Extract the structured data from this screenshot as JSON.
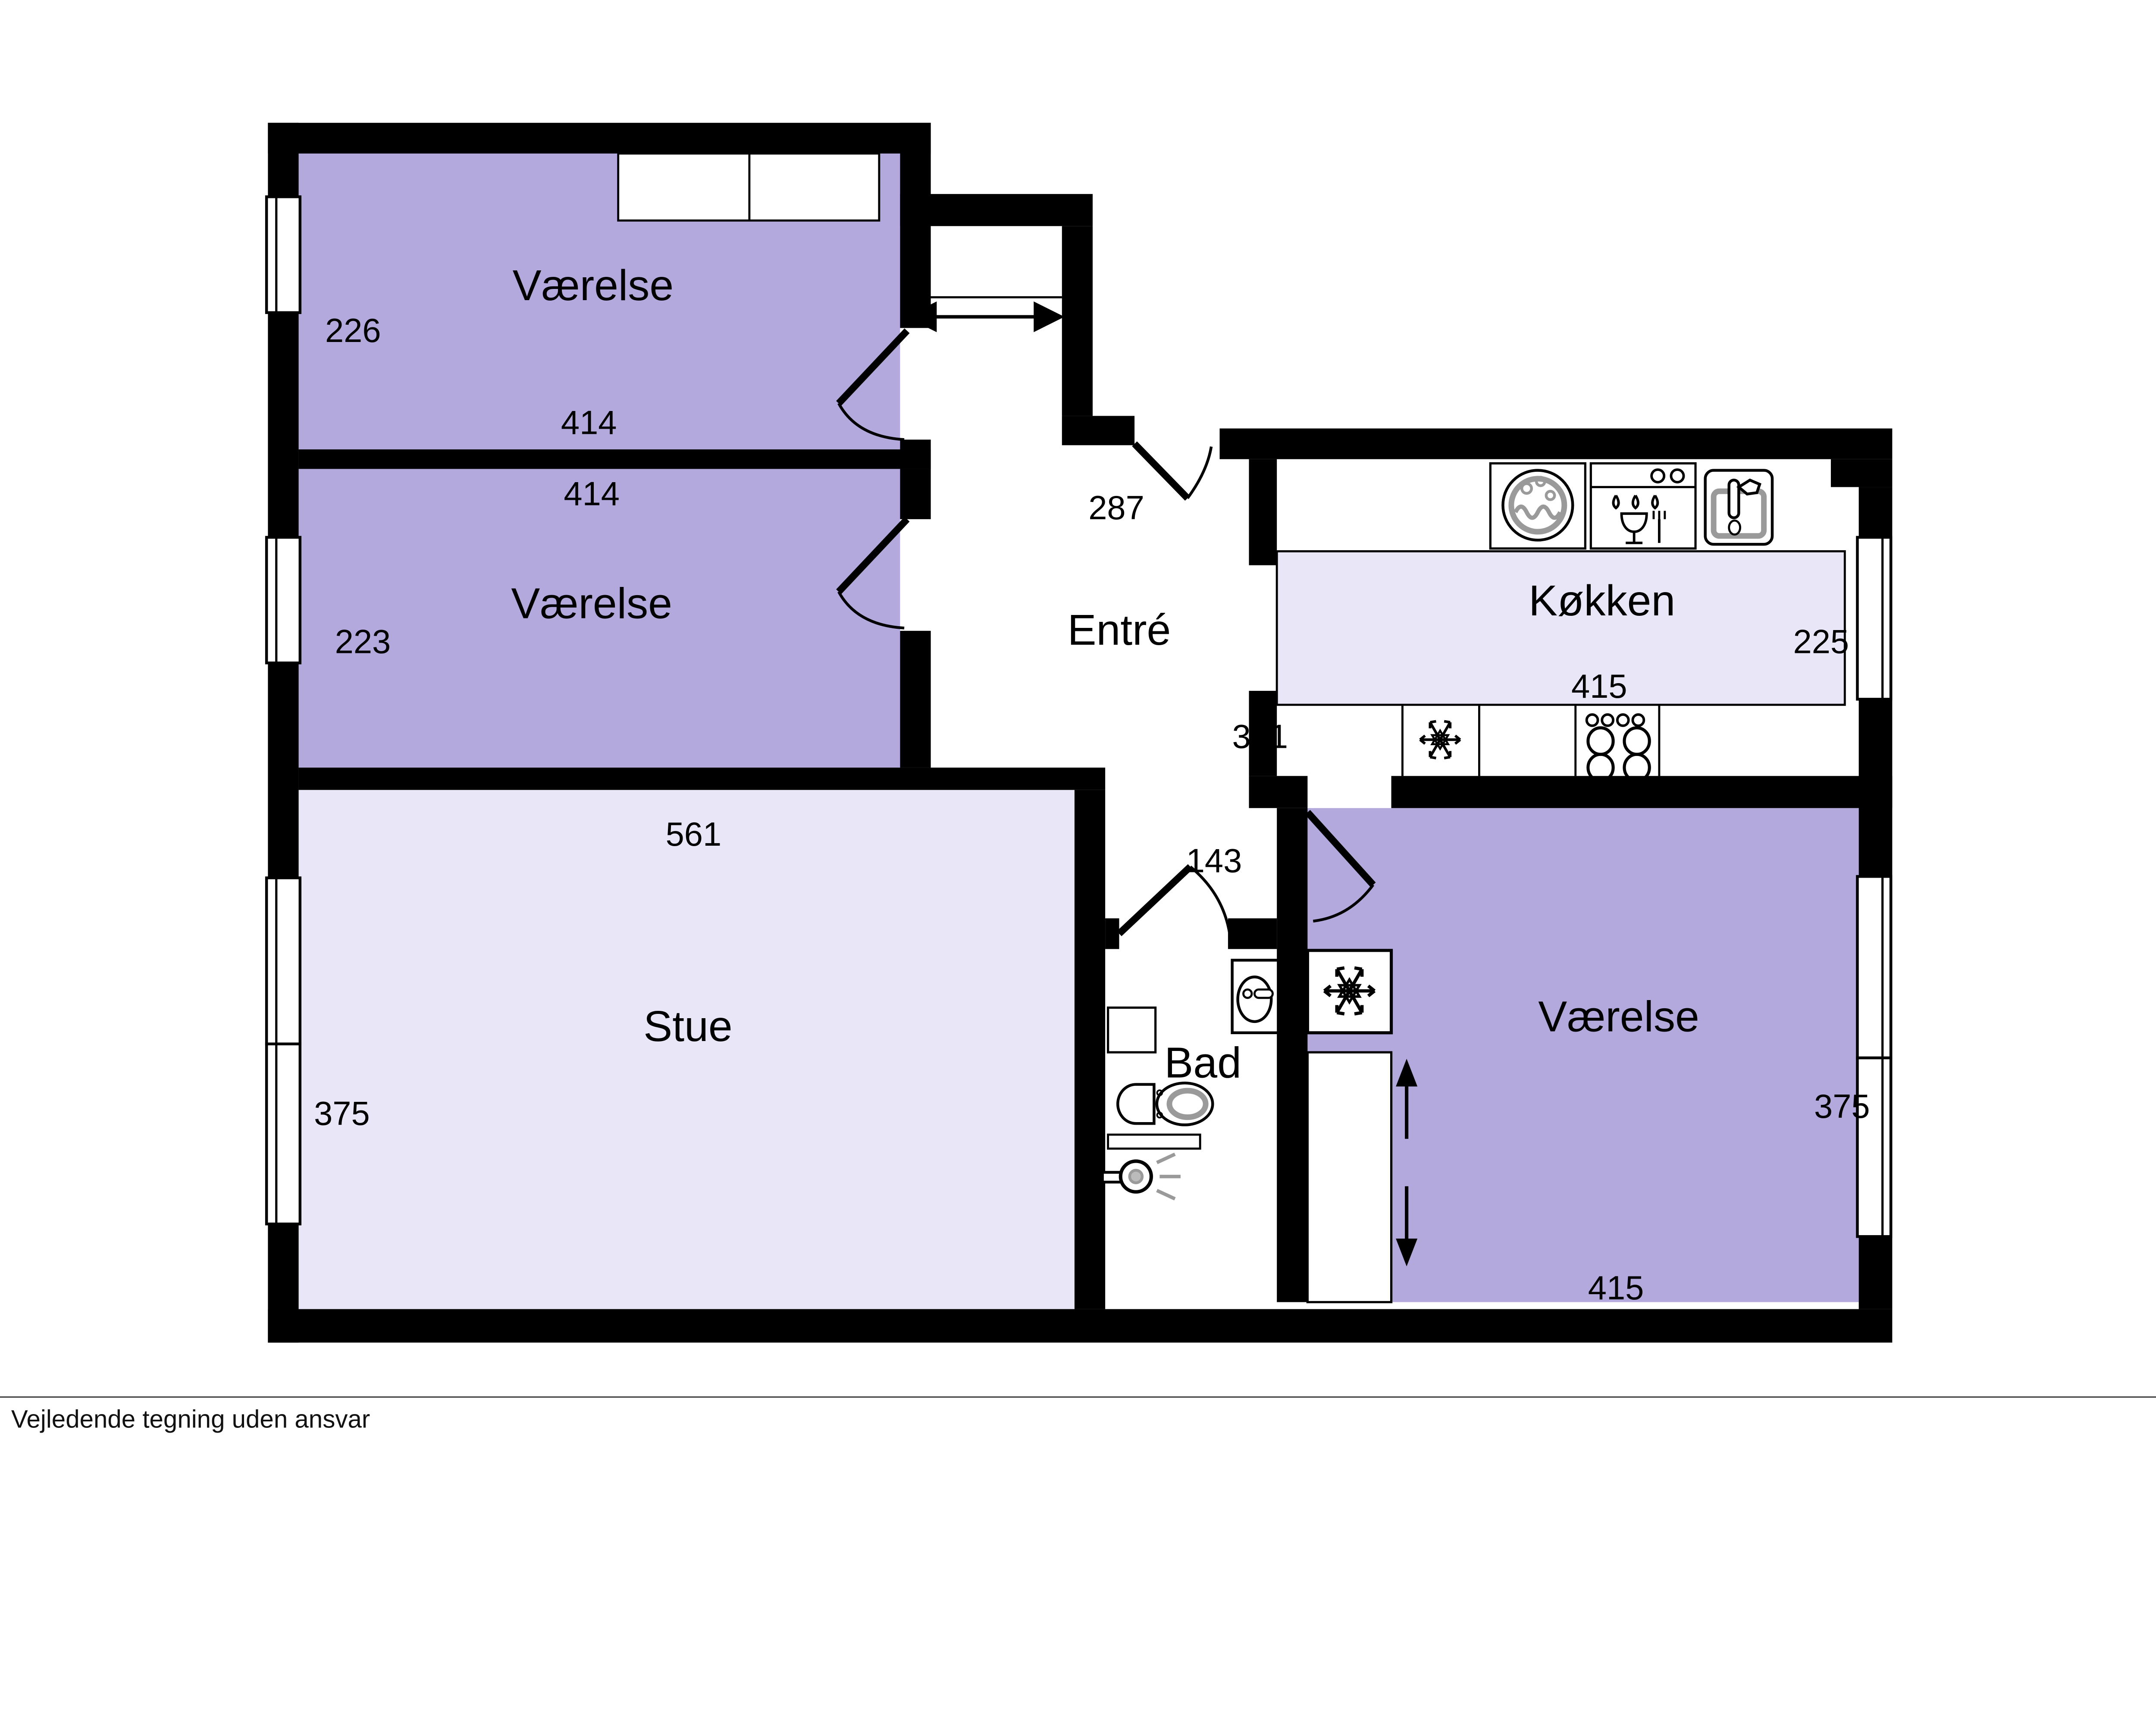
{
  "document": {
    "type": "floor-plan",
    "footer_disclaimer": "Vejledende tegning uden ansvar"
  },
  "colors": {
    "wall": "#000000",
    "room_fill": "#b3a9dc",
    "living_fill": "#e9e6f7",
    "fixture_gray": "#9a9a9a",
    "background": "#ffffff"
  },
  "rooms": [
    {
      "key": "vaerelse-nw",
      "name": "Værelse",
      "width_cm": "414",
      "depth_cm": "226"
    },
    {
      "key": "vaerelse-w",
      "name": "Værelse",
      "width_cm": "414",
      "depth_cm": "223"
    },
    {
      "key": "stue",
      "name": "Stue",
      "width_cm": "561",
      "depth_cm": "375"
    },
    {
      "key": "entre",
      "name": "Entré",
      "entry_cm": "287",
      "passage_cm": "341",
      "bath_opening_cm": "143"
    },
    {
      "key": "kokken",
      "name": "Køkken",
      "width_cm": "415",
      "depth_cm": "225"
    },
    {
      "key": "bad",
      "name": "Bad"
    },
    {
      "key": "vaerelse-se",
      "name": "Værelse",
      "width_cm": "415",
      "depth_cm": "375"
    }
  ],
  "icons": {
    "washing_machine": "◉",
    "dishwasher": "🍷",
    "kitchen_sink": "🚰",
    "freezer": "❄",
    "stove": "◯◯◯◯",
    "bath_sink": "🛁",
    "toilet": "🚽",
    "shower": "🚿",
    "entrance_swing": "↔",
    "vent_up": "↑",
    "vent_down": "↓",
    "window": "▭"
  }
}
